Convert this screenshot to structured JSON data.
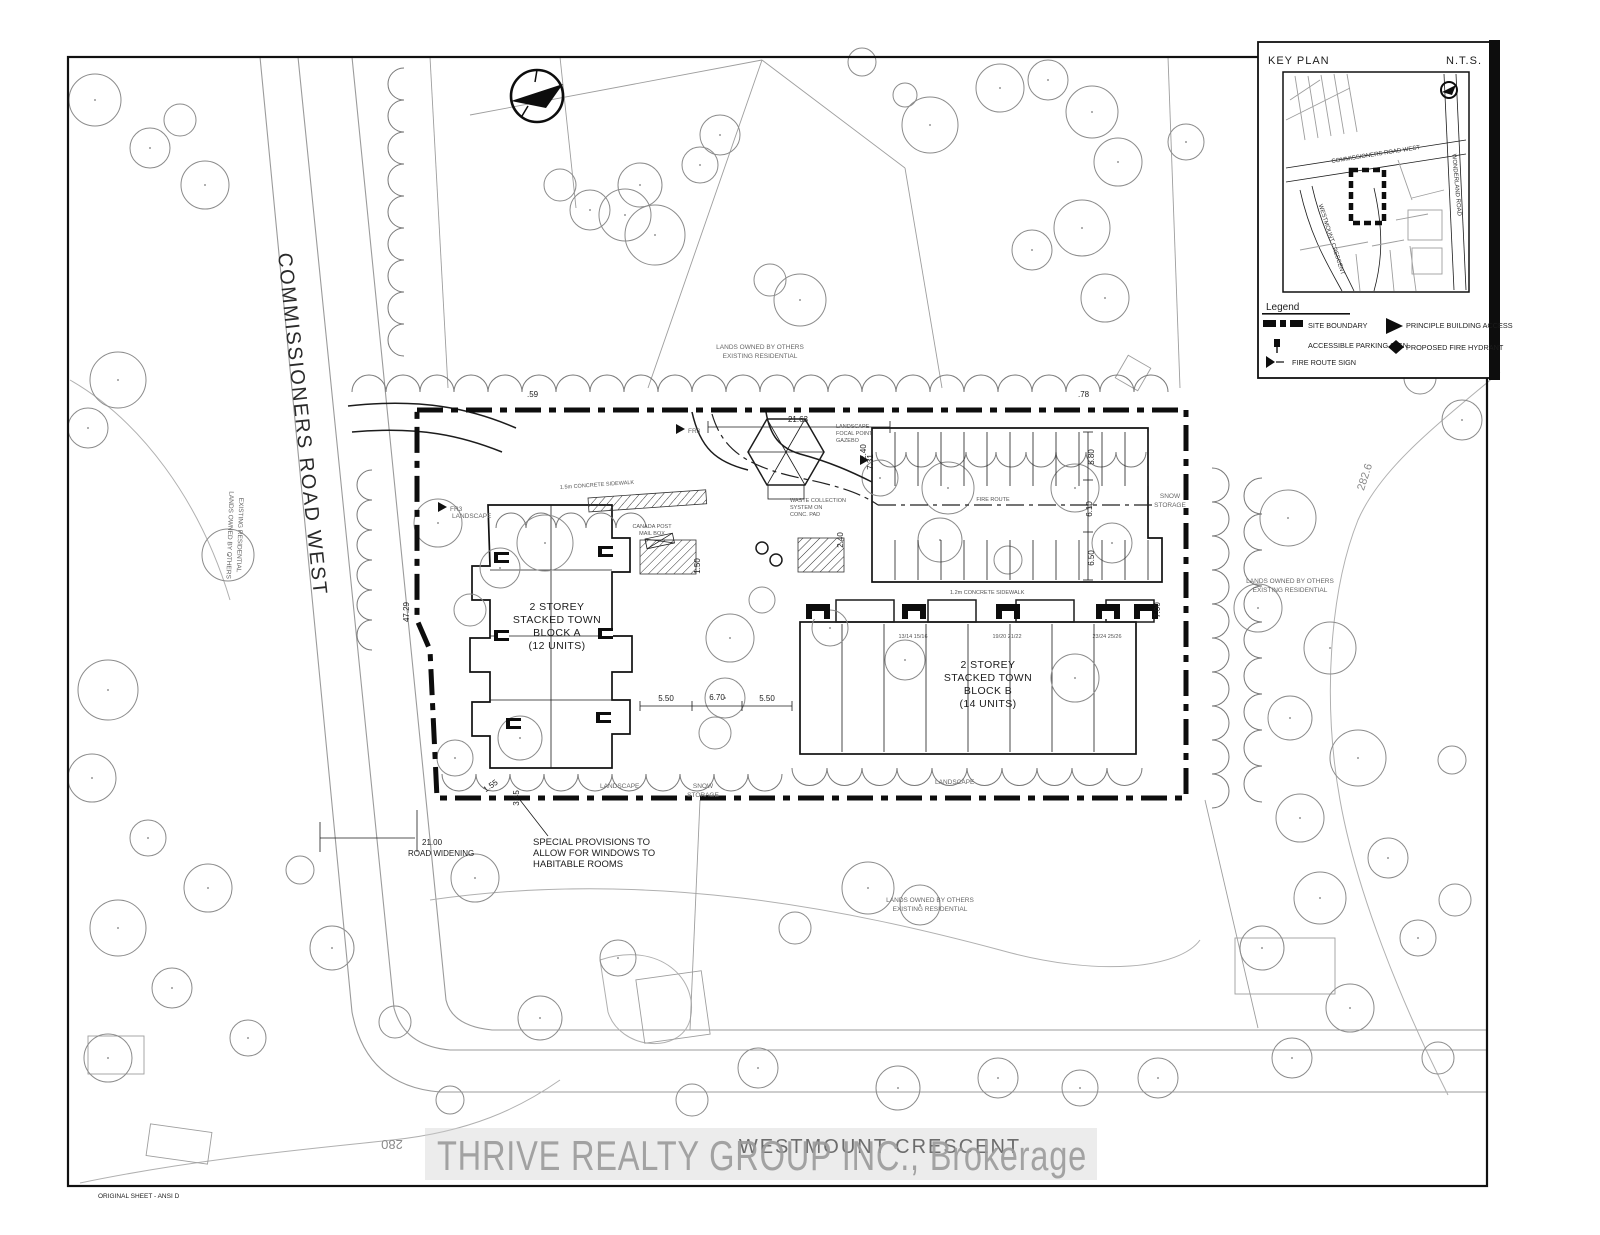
{
  "palette": {
    "ink": "#1c1c1c",
    "gray_line": "#9b9b9b",
    "tree": "#8b8b8b",
    "watermark": "#9b9b9b"
  },
  "sheet": {
    "watermark": "THRIVE REALTY GROUP INC., Brokerage",
    "footer_note": "ORIGINAL SHEET - ANSI D"
  },
  "key_plan": {
    "title": "KEY PLAN",
    "scale_note": "N.T.S.",
    "road_commissioners": "COMMISSIONERS ROAD WEST",
    "road_wonderland": "WONDERLAND ROAD",
    "road_westmount": "WESTMOUNT CRESCENT"
  },
  "legend": {
    "title": "Legend",
    "items": [
      {
        "icon": "site-boundary-dash",
        "label": "SITE BOUNDARY"
      },
      {
        "icon": "building-access-triangle",
        "label": "PRINCIPLE BUILDING ACCESS"
      },
      {
        "icon": "accessible-parking-sign",
        "label": "ACCESSIBLE PARKING SIGN"
      },
      {
        "icon": "fire-hydrant-diamond",
        "label": "PROPOSED FIRE HYDRANT"
      },
      {
        "icon": "fire-route-flag",
        "label": "FIRE ROUTE SIGN"
      }
    ]
  },
  "streets": {
    "commissioners": "COMMISSIONERS ROAD WEST",
    "westmount": "WESTMOUNT CRESCENT"
  },
  "blocks": {
    "a": {
      "lines": [
        "2 STOREY",
        "STACKED TOWN",
        "BLOCK A",
        "(12 UNITS)"
      ]
    },
    "b": {
      "lines": [
        "2 STOREY",
        "STACKED TOWN",
        "BLOCK B",
        "(14 UNITS)"
      ]
    }
  },
  "notes": {
    "lands_owned_1": "LANDS OWNED BY OTHERS",
    "lands_owned_2": "EXISTING RESIDENTIAL",
    "special": [
      "SPECIAL PROVISIONS TO",
      "ALLOW FOR WINDOWS TO",
      "HABITABLE ROOMS"
    ],
    "road_widening_dim": "21.00",
    "road_widening": "ROAD WIDENING",
    "gazebo": [
      "LANDSCAPE",
      "FOCAL POINT",
      "GAZEBO"
    ],
    "waste": [
      "WASTE COLLECTION",
      "SYSTEM ON",
      "CONC. PAD"
    ],
    "canada_post": [
      "CANADA POST",
      "MAIL BOX"
    ],
    "landscape": "LANDSCAPE",
    "fire_route": "FIRE ROUTE",
    "snow": "SNOW",
    "storage": "STORAGE",
    "sidewalk_15": "1.5m CONCRETE SIDEWALK",
    "sidewalk_12": "1.2m CONCRETE SIDEWALK",
    "fire_sign": "FR3"
  },
  "dims": {
    "d2163": "21.63",
    "d240": "2.40",
    "d150": "1.50",
    "d4729": "47.29",
    "d550a": "5.50",
    "d670": "6.70",
    "d550b": "5.50",
    "d731": "7.31",
    "d580": "5.80",
    "d610": "6.10",
    "d650": "6.50",
    "d700": "7.00",
    "d155": "1.55",
    "d345": "3.45",
    "d059": ".59",
    "d078": ".78",
    "c280": "280",
    "c2826": "282.6"
  },
  "units_b": [
    "13/14  15/16",
    "19/20  21/22",
    "23/24  25/26"
  ]
}
